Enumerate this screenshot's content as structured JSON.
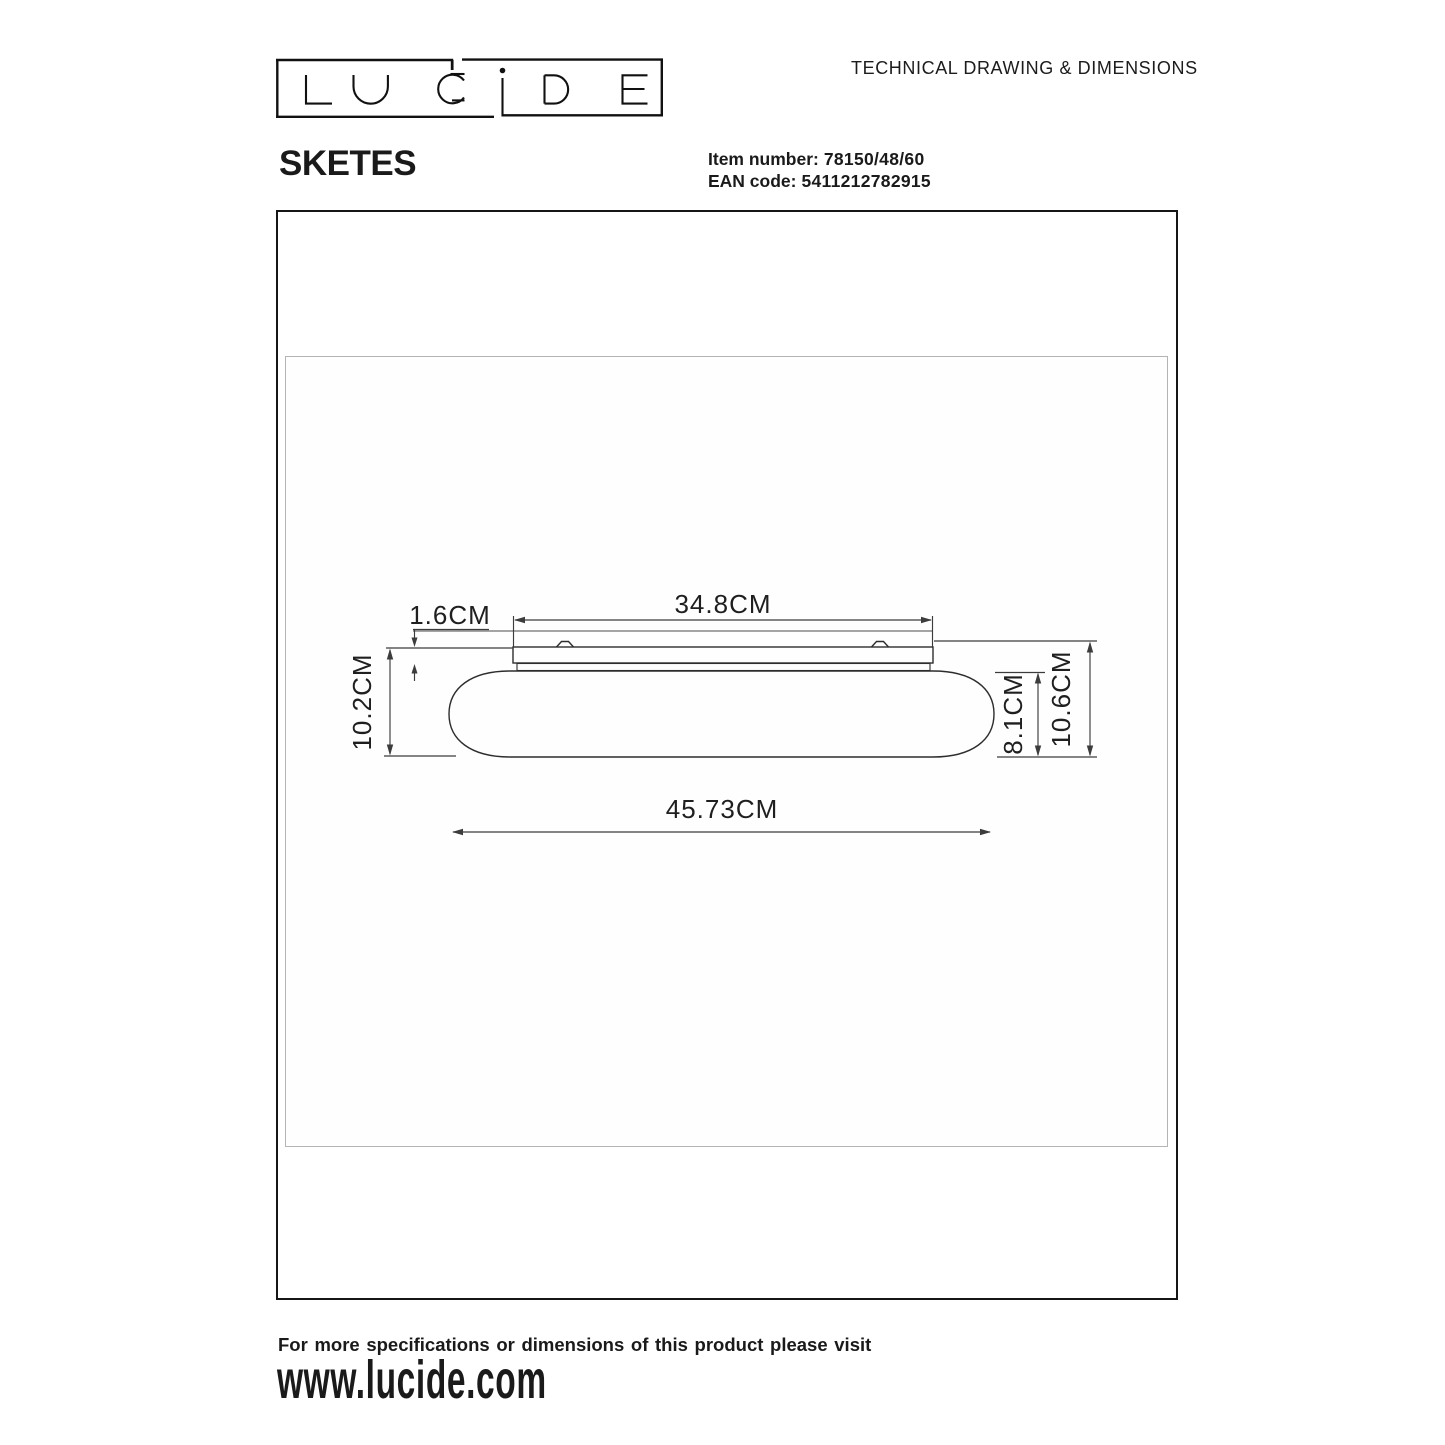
{
  "page": {
    "title": "TECHNICAL DRAWING & DIMENSIONS"
  },
  "logo": {
    "brand": "LUCIDE"
  },
  "product": {
    "name": "SKETES",
    "item_number_label": "Item number:",
    "item_number": "78150/48/60",
    "ean_label": "EAN code:",
    "ean_code": "5411212782915"
  },
  "drawing": {
    "labels": {
      "plate_width": "34.8CM",
      "plate_thickness": "1.6CM",
      "total_height_left": "10.2CM",
      "total_width": "45.73CM",
      "body_height": "8.1CM",
      "total_height_right": "10.6CM"
    }
  },
  "footer": {
    "line1": "For more specifications or dimensions of this product please visit",
    "line2": "www.lucide.com"
  },
  "colors": {
    "ink": "#1a1a1a",
    "drawing_line": "#3a3a3a",
    "frame_gray": "#b4b4b4"
  }
}
